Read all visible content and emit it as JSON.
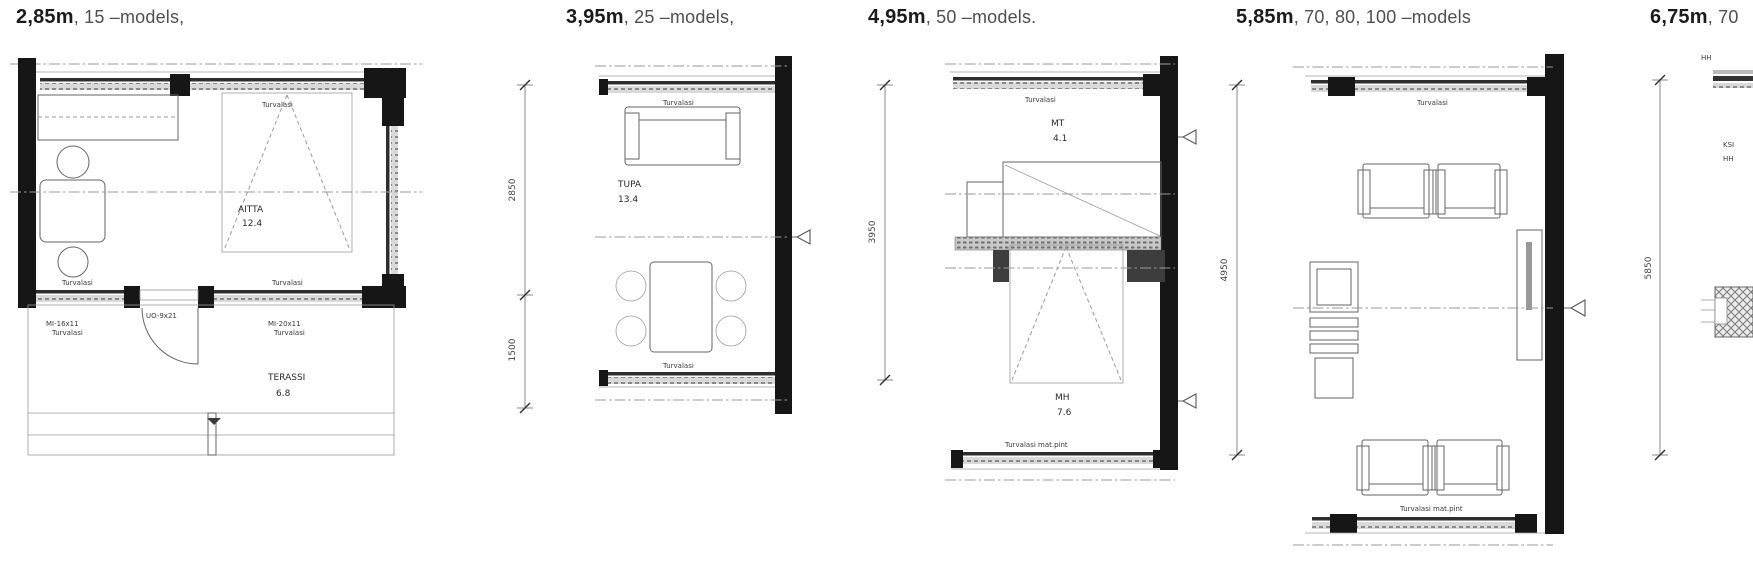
{
  "colors": {
    "wall": "#161616",
    "line": "#666666",
    "centerline": "#9a9a9a",
    "text": "#333333"
  },
  "panels": [
    {
      "title": "2,85m",
      "models": ", 15 –models,",
      "labels": {
        "glass_top": "Turvalasi",
        "glass_bottom_left": "Turvalasi",
        "glass_bottom_right": "Turvalasi",
        "window_left_code": "MI-16x11",
        "window_left_glass": "Turvalasi",
        "door_code": "UO-9x21",
        "window_right_code": "MI-20x11",
        "window_right_glass": "Turvalasi",
        "room": "AITTA",
        "room_area": "12.4",
        "terrace": "TERASSI",
        "terrace_area": "6.8"
      }
    },
    {
      "title": "3,95m",
      "models": ", 25 –models,",
      "dims": [
        "2850",
        "1500"
      ],
      "labels": {
        "glass_top": "Turvalasi",
        "room": "TUPA",
        "room_area": "13.4",
        "glass_bottom": "Turvalasi"
      }
    },
    {
      "title": "4,95m",
      "models": ", 50 –models.",
      "dims": [
        "3950"
      ],
      "labels": {
        "glass_top": "Turvalasi",
        "room_top": "MT",
        "room_top_area": "4.1",
        "room_bottom": "MH",
        "room_bottom_area": "7.6",
        "glass_bottom": "Turvalasi mat.pint"
      }
    },
    {
      "title": "5,85m",
      "models": ", 70, 80, 100 –models",
      "dims": [
        "4950"
      ],
      "labels": {
        "glass_top": "Turvalasi",
        "glass_bottom": "Turvalasi mat.pint"
      }
    },
    {
      "title": "6,75m",
      "models": ", 70",
      "dims": [
        "5850"
      ],
      "labels": {
        "top": "HH",
        "mid_line1": "KSI",
        "mid_line2": "HH"
      }
    }
  ]
}
